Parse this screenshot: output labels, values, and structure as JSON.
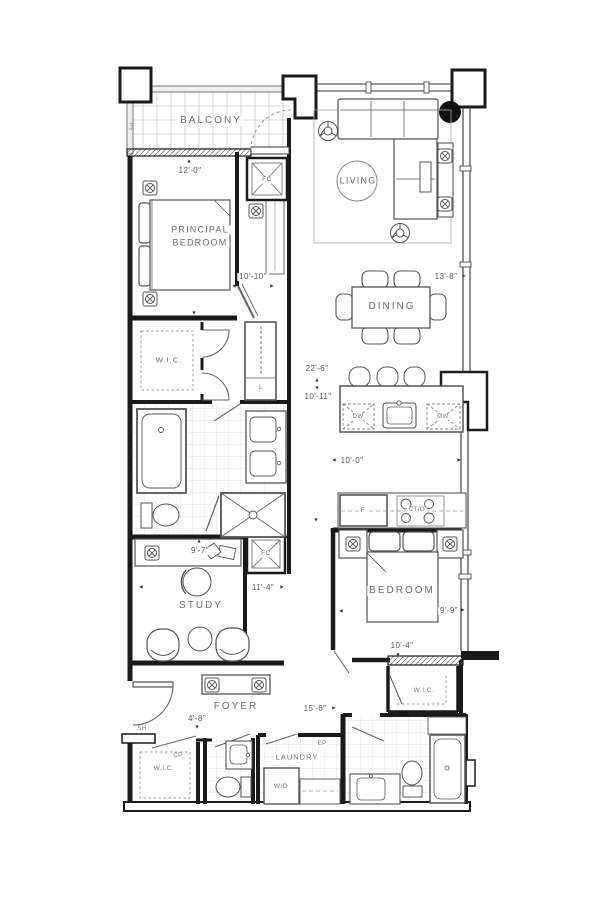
{
  "glyphs": {
    "up": "▲",
    "down": "▼",
    "left": "◄",
    "right": "►"
  },
  "labels": {
    "balcony": "BALCONY",
    "principal_bedroom_line1": "PRINCIPAL",
    "principal_bedroom_line2": "BEDROOM",
    "living": "LIVING",
    "dining": "DINING",
    "study": "STUDY",
    "bedroom": "BEDROOM",
    "foyer": "FOYER",
    "laundry": "LAUNDRY",
    "wic_principal": "W.I.C.",
    "wic_bedroom": "W.I.C.",
    "wic_foyer": "W.I.C.",
    "linen_closet": "L",
    "fc_balcony": "FC",
    "fc_study": "FC",
    "pipe_space": "PS",
    "shelf": "SH",
    "cp": "CP",
    "electrical_panel": "EP",
    "washer_dryer": "W/D",
    "dishwasher": "DW",
    "microwave": "MW",
    "fridge": "F",
    "cooktop_oven": "CT/O"
  },
  "dimensions": {
    "balcony": "12'-0\"",
    "principal_bedroom": "10'-10\"",
    "living": "13'-8\"",
    "unit_length": "22'-6\"",
    "dining": "10'-11\"",
    "kitchen": "10'-0\"",
    "study_width": "9'-7\"",
    "study_length": "11'-4\"",
    "bedroom_width": "9'-9\"",
    "bedroom_length": "10'-4\"",
    "foyer_width": "4'-8\"",
    "foyer_length": "15'-6\""
  }
}
